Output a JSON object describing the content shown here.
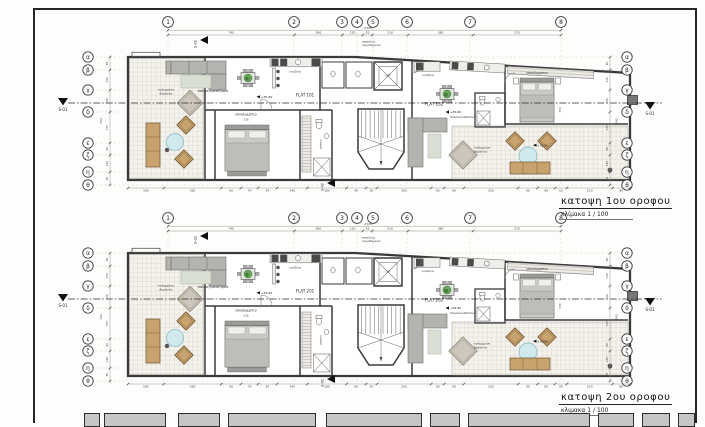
{
  "drawing": {
    "grid_numbers": [
      "1",
      "2",
      "3",
      "4",
      "5",
      "6",
      "7",
      "8"
    ],
    "grid_letters": [
      "α",
      "β",
      "γ",
      "δ",
      "ε",
      "ζ",
      "η",
      "θ"
    ],
    "section_markers": {
      "s01": "S-01",
      "s02": "S-02"
    },
    "dimensions": {
      "top_total": "2325",
      "top": [
        "740",
        "280",
        "120",
        "55",
        "210",
        "380",
        "515"
      ],
      "bottom": [
        "165",
        "265",
        "90",
        "79",
        "87",
        "140",
        "180",
        "90",
        "50",
        "250",
        "60",
        "90",
        "250",
        "90",
        "80",
        "55",
        "210",
        "80"
      ],
      "side": [
        "85",
        "130",
        "190",
        "275",
        "90",
        "120",
        "65"
      ],
      "side_total": "742",
      "bed1_width": "326",
      "bed2_width": "330"
    },
    "rooms": {
      "veranda_line1": "καλυμμένη",
      "veranda_line2": "βεράντα",
      "living_dining": "σαλόνι/τραπεζαρία",
      "living_sitting": "σαλόνι/καθιστικό",
      "kitchen": "κουζίνα",
      "bedroom": "υπνοδωμάτιο",
      "bathroom": "μπάνιο",
      "lift": "LIFT",
      "note_line1": "ασφαλείας",
      "note_line2": "ανεμοθώρακας"
    },
    "plans": [
      {
        "title": "κατοψη 1ου οροφου",
        "scale_label": "κλίμακα 1 / 100",
        "flat_left": "FLAT 101",
        "flat_right": "FLAT 102",
        "elevation": "+35,80"
      },
      {
        "title": "κατοψη 2ου οροφου",
        "scale_label": "κλιμακα 1 / 100",
        "flat_left": "FLAT 201",
        "flat_right": "FLAT 202",
        "elevation": "+39,80"
      }
    ],
    "colors": {
      "wall": "#3a3a3a",
      "hatch_bg": "#f4f2ec",
      "hatch_line": "#c8c3b6",
      "sofa": "#b3b3af",
      "rug": "#dadfd3",
      "bed": "#c9c9c5",
      "pillow": "#efefec",
      "wood": "#c8a36e",
      "wood_dark": "#6e532f",
      "table_blue": "#cfe9ef",
      "table_blue_stroke": "#84b7c3",
      "plant": "#6ba45c",
      "plant_dark": "#3f7a35",
      "rug_diamond": "#cdc7bb",
      "rug_diamond_stroke": "#8e887b",
      "appliance": "#4b4b49",
      "dim_text": "#3d3d3d",
      "titleblock_fill": "#c6c6c6"
    }
  }
}
